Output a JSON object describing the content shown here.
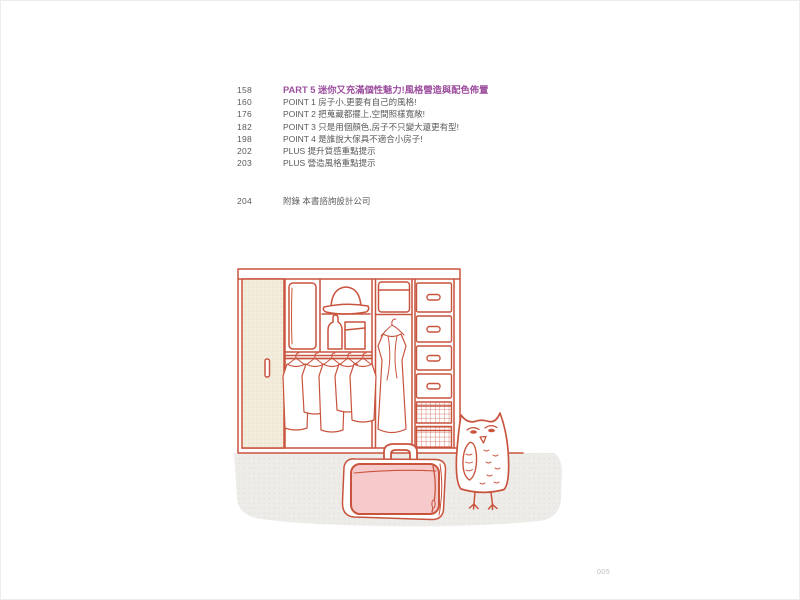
{
  "page": {
    "folio": "005"
  },
  "toc": {
    "part": {
      "page": "158",
      "label": "PART 5 迷你又充滿個性魅力!風格營造與配色佈置"
    },
    "entries": [
      {
        "page": "160",
        "label": "POINT 1 房子小,更要有自己的風格!"
      },
      {
        "page": "176",
        "label": "POINT 2 把蒐藏都擺上,空間照樣寬敞!"
      },
      {
        "page": "182",
        "label": "POINT 3 只是用個顏色,房子不只變大還更有型!"
      },
      {
        "page": "198",
        "label": "POINT 4 是誰說大傢具不適合小房子!"
      },
      {
        "page": "202",
        "label": "PLUS 提升質感重點提示"
      },
      {
        "page": "203",
        "label": "PLUS 營造風格重點提示"
      }
    ],
    "appendix": {
      "page": "204",
      "label": "附錄 本書諮詢設計公司"
    }
  },
  "illustration": {
    "description": "hand-drawn wardrobe with folded duvet, hat, hanging shirts, long dress, drawers, wire baskets, a pink travel bag and an owl standing beside it",
    "colors": {
      "line": "#c9543e",
      "bag_pink": "#f6c9ca",
      "door_beige": "#f2ecdc",
      "floor_gray": "#edece9",
      "heading_purple": "#9c4f9e",
      "text_gray": "#5a5a5a"
    }
  }
}
